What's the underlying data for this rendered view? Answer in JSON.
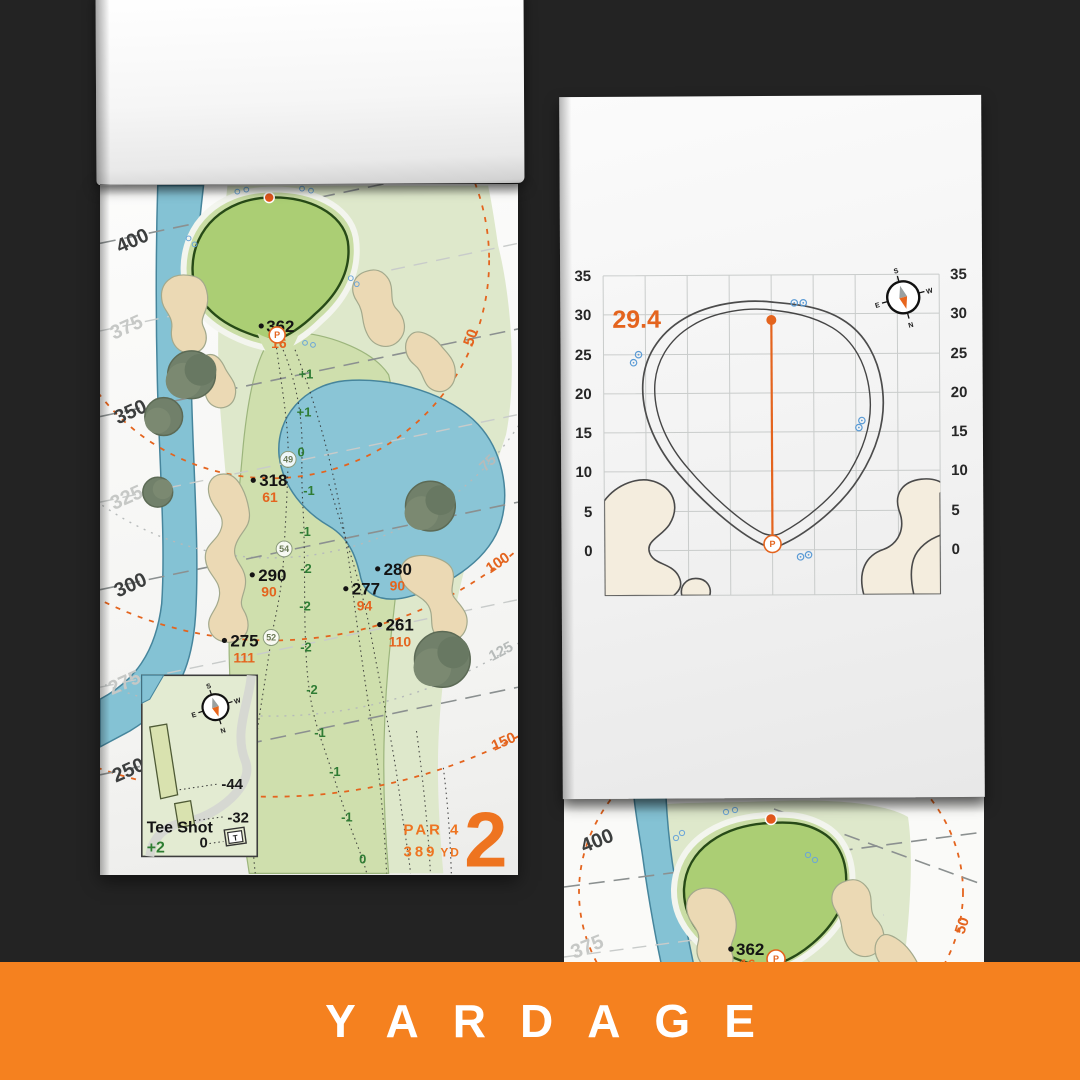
{
  "banner": {
    "label": "YARDAGE"
  },
  "colors": {
    "background": "#232323",
    "banner_orange": "#f5811f",
    "accent_orange": "#e4641e",
    "elevation_green": "#2f7c34",
    "water_blue": "#84c2d4",
    "bunker_sand": "#ebd9b4",
    "fairway_green": "#cfdfad",
    "putting_green": "#abce74"
  },
  "hole_map": {
    "hole_number": "2",
    "par_label": "PAR 4",
    "yardage_value": "389",
    "yardage_unit": "YD",
    "distance_lines": [
      {
        "label": "400",
        "tone": "dark"
      },
      {
        "label": "375",
        "tone": "light"
      },
      {
        "label": "350",
        "tone": "dark"
      },
      {
        "label": "325",
        "tone": "light"
      },
      {
        "label": "300",
        "tone": "dark"
      },
      {
        "label": "275",
        "tone": "light"
      },
      {
        "label": "250",
        "tone": "dark"
      }
    ],
    "radius_arcs": [
      {
        "label": "50",
        "tone": "orange"
      },
      {
        "label": "75",
        "tone": "gray"
      },
      {
        "label": "100",
        "tone": "orange"
      },
      {
        "label": "125",
        "tone": "gray"
      },
      {
        "label": "150",
        "tone": "orange"
      }
    ],
    "yardage_markers": [
      {
        "distance": "362",
        "front": "16"
      },
      {
        "distance": "318",
        "front": "61"
      },
      {
        "distance": "290",
        "front": "90"
      },
      {
        "distance": "280",
        "front": "90"
      },
      {
        "distance": "277",
        "front": "94"
      },
      {
        "distance": "261",
        "front": "110"
      },
      {
        "distance": "275",
        "front": "111"
      }
    ],
    "waypoints": [
      "49",
      "54",
      "52"
    ],
    "elevations": [
      "+1",
      "+1",
      "0",
      "-1",
      "-1",
      "-2",
      "-2",
      "-2",
      "-2",
      "-1",
      "-1",
      "-1",
      "0"
    ],
    "pin_symbol": "P",
    "compass": {
      "n": "N",
      "s": "S",
      "e": "E",
      "w": "W"
    },
    "tee_inset": {
      "title": "Tee Shot",
      "shot_elevation": "+2",
      "offsets": [
        "-44",
        "-32",
        "0"
      ],
      "tee_letter": "T"
    }
  },
  "green_map": {
    "depth_value": "29.4",
    "ticks": [
      "35",
      "30",
      "25",
      "20",
      "15",
      "10",
      "5",
      "0"
    ],
    "pin_symbol": "P",
    "compass": {
      "n": "N",
      "s": "S",
      "e": "E",
      "w": "W"
    }
  },
  "next_page": {
    "distance_lines": [
      {
        "label": "400",
        "tone": "dark"
      },
      {
        "label": "375",
        "tone": "light"
      }
    ],
    "radius_label": "50",
    "marker": {
      "distance": "362",
      "front": "16"
    },
    "pin_symbol": "P"
  }
}
